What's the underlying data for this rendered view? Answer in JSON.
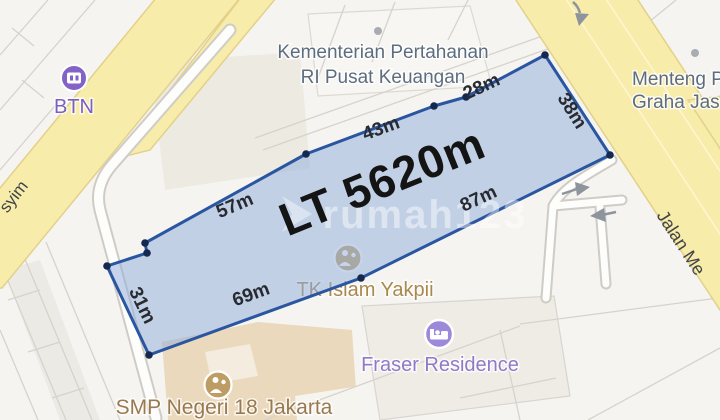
{
  "map": {
    "watermark_text": "rumah123",
    "plot": {
      "area_label": "LT 5620m",
      "side_labels": [
        "28m",
        "43m",
        "57m",
        "31m",
        "69m",
        "87m",
        "38m"
      ]
    },
    "pois": {
      "ministry": {
        "line1": "Kementerian Pertahanan",
        "line2": "RI Pusat Keuangan"
      },
      "btn": {
        "label": "BTN"
      },
      "menteng": {
        "line1": "Menteng P",
        "line2": "Graha Jas"
      },
      "tk_islam": {
        "label": "TK Islam Yakpii"
      },
      "fraser": {
        "label": "Fraser Residence"
      },
      "smp": {
        "label": "SMP Negeri 18 Jakarta"
      }
    },
    "roads": {
      "left_label": "syim",
      "right_label": "Jalan Me"
    },
    "colors": {
      "plot_fill": "#bfcfe9",
      "plot_border": "#2a55a0",
      "vertex_dot": "#14294f",
      "road_yellow": "#f8ecab",
      "road_border": "#e2d18a",
      "poi_purple": "#7a5ec0",
      "poi_tan": "#a8894e",
      "poi_brown": "#997950",
      "label_slate": "#5d6d80"
    }
  }
}
